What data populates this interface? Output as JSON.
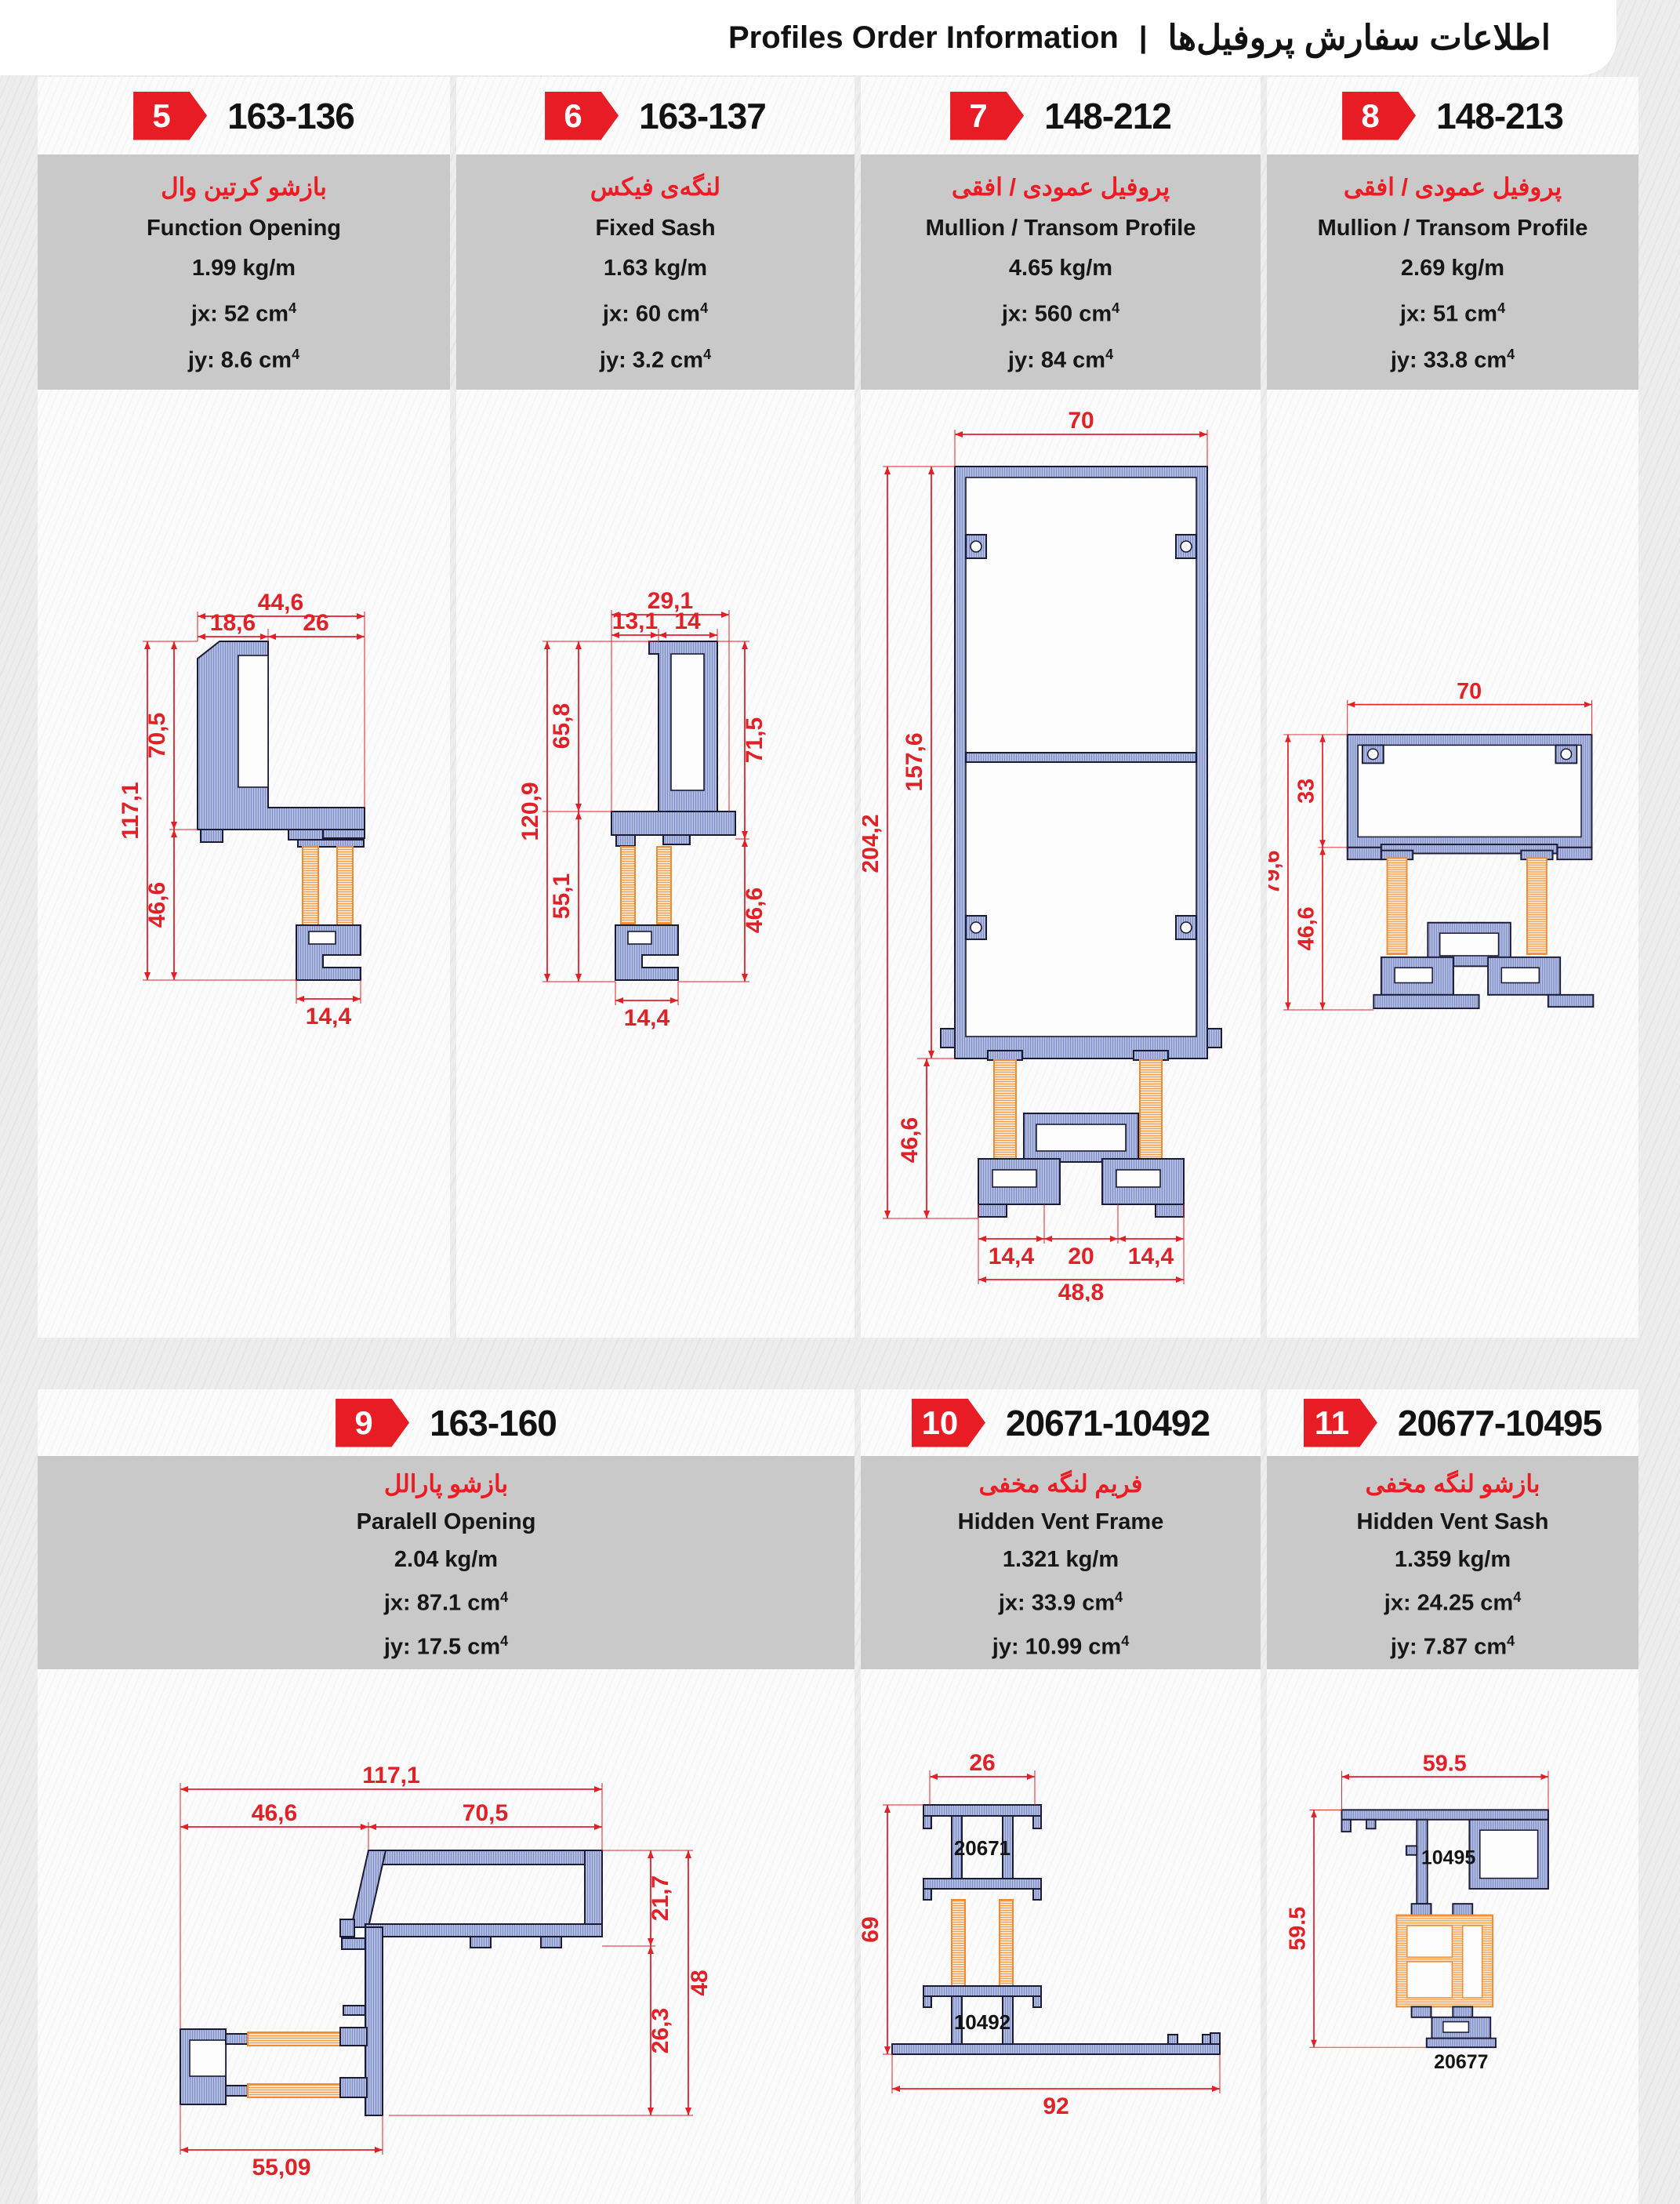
{
  "header": {
    "title_en": "Profiles Order Information",
    "separator": "|",
    "title_fa": "اطلاعات سفارش پروفیل‌ها"
  },
  "cards": [
    {
      "num": "5",
      "code": "163-136",
      "name_fa": "بازشو کرتین وال",
      "name_en": "Function Opening",
      "weight": "1.99 kg/m",
      "jx": "jx: 52 cm",
      "jy": "jy: 8.6 cm",
      "sup": "4",
      "dims": {
        "w": "44,6",
        "w1": "18,6",
        "w2": "26",
        "h": "117,1",
        "h1": "70,5",
        "h2": "46,6",
        "b": "14,4"
      }
    },
    {
      "num": "6",
      "code": "163-137",
      "name_fa": "لنگه‌ی فیکس",
      "name_en": "Fixed Sash",
      "weight": "1.63 kg/m",
      "jx": "jx: 60 cm",
      "jy": "jy: 3.2 cm",
      "sup": "4",
      "dims": {
        "w": "29,1",
        "w1": "13,1",
        "w2": "14",
        "h": "120,9",
        "h1": "65,8",
        "h2": "55,1",
        "r1": "71,5",
        "r2": "46,6",
        "b": "14,4"
      }
    },
    {
      "num": "7",
      "code": "148-212",
      "name_fa": "پروفیل عمودی / افقی",
      "name_en": "Mullion / Transom Profile",
      "weight": "4.65 kg/m",
      "jx": "jx: 560 cm",
      "jy": "jy: 84 cm",
      "sup": "4",
      "dims": {
        "w": "70",
        "h": "204,2",
        "h1": "157,6",
        "h2": "46,6",
        "b1": "14,4",
        "b2": "20",
        "b3": "14,4",
        "b": "48,8"
      }
    },
    {
      "num": "8",
      "code": "148-213",
      "name_fa": "پروفیل عمودی / افقی",
      "name_en": "Mullion / Transom Profile",
      "weight": "2.69 kg/m",
      "jx": "jx: 51 cm",
      "jy": "jy: 33.8 cm",
      "sup": "4",
      "dims": {
        "w": "70",
        "h": "79,6",
        "h1": "33",
        "h2": "46,6"
      }
    },
    {
      "num": "9",
      "code": "163-160",
      "name_fa": "بازشو پارالل",
      "name_en": "Paralell Opening",
      "weight": "2.04 kg/m",
      "jx": "jx: 87.1 cm",
      "jy": "jy: 17.5 cm",
      "sup": "4",
      "dims": {
        "w": "117,1",
        "w1": "46,6",
        "w2": "70,5",
        "r1": "21,7",
        "r": "48",
        "r2": "26,3",
        "b": "55,09"
      }
    },
    {
      "num": "10",
      "code": "20671-10492",
      "name_fa": "فریم لنگه مخفی",
      "name_en": "Hidden Vent Frame",
      "weight": "1.321 kg/m",
      "jx": "jx: 33.9 cm",
      "jy": "jy: 10.99 cm",
      "sup": "4",
      "dims": {
        "w": "26",
        "h": "69",
        "b": "92",
        "l1": "20671",
        "l2": "10492"
      }
    },
    {
      "num": "11",
      "code": "20677-10495",
      "name_fa": "بازشو لنگه مخفی",
      "name_en": "Hidden Vent Sash",
      "weight": "1.359 kg/m",
      "jx": "jx: 24.25 cm",
      "jy": "jy: 7.87 cm",
      "sup": "4",
      "dims": {
        "w": "59.5",
        "h": "59.5",
        "l1": "10495",
        "l2": "20677"
      }
    }
  ]
}
